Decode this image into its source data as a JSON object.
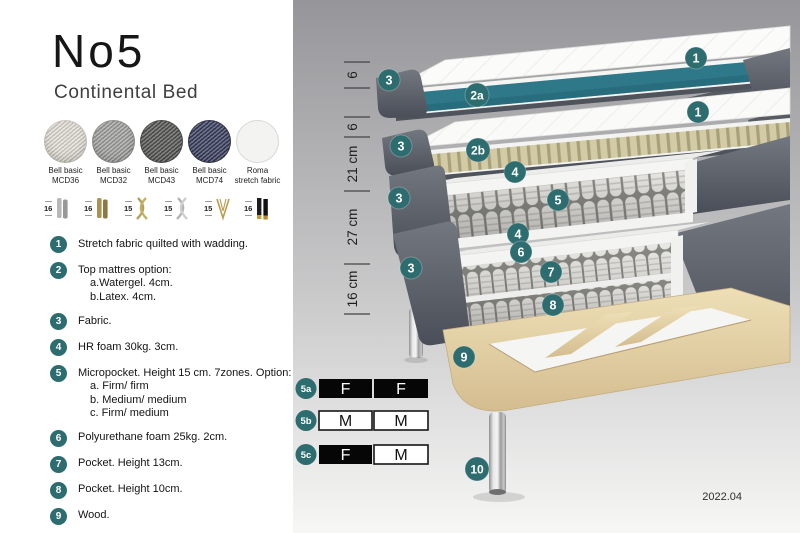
{
  "header": {
    "title": "No5",
    "subtitle": "Continental Bed"
  },
  "fabrics": [
    {
      "name": "Bell basic",
      "code": "MCD36",
      "swatch_style": "background:#e2dfd6"
    },
    {
      "name": "Bell basic",
      "code": "MCD32",
      "swatch_style": "background:#a2a2a0"
    },
    {
      "name": "Bell basic",
      "code": "MCD43",
      "swatch_style": "background:#565654"
    },
    {
      "name": "Bell basic",
      "code": "MCD74",
      "swatch_style": "background:#3b3f5e"
    },
    {
      "name": "Roma",
      "code": "stretch fabric",
      "swatch_style": "background:#f3f3f1"
    }
  ],
  "legs": [
    {
      "height": "16",
      "finish": "chrome cylinder"
    },
    {
      "height": "16",
      "finish": "brass cylinder"
    },
    {
      "height": "15",
      "finish": "gold twisted"
    },
    {
      "height": "15",
      "finish": "silver twisted"
    },
    {
      "height": "15",
      "finish": "gold hairpin"
    },
    {
      "height": "16",
      "finish": "black with gold tip"
    }
  ],
  "features": [
    {
      "num": "1",
      "lines": [
        "Stretch fabric quilted with wadding."
      ]
    },
    {
      "num": "2",
      "lines": [
        "Top mattres option:",
        "a.Watergel. 4cm.",
        "b.Latex. 4cm."
      ]
    },
    {
      "num": "3",
      "lines": [
        "Fabric."
      ]
    },
    {
      "num": "4",
      "lines": [
        "HR foam 30kg. 3cm."
      ]
    },
    {
      "num": "5",
      "lines": [
        "Micropocket. Height 15 cm. 7zones. Option:",
        "a. Firm/ firm",
        "b. Medium/ medium",
        "c. Firm/ medium"
      ]
    },
    {
      "num": "6",
      "lines": [
        "Polyurethane foam 25kg. 2cm."
      ]
    },
    {
      "num": "7",
      "lines": [
        "Pocket. Height 13cm."
      ]
    },
    {
      "num": "8",
      "lines": [
        "Pocket. Height 10cm."
      ]
    },
    {
      "num": "9",
      "lines": [
        "Wood."
      ]
    },
    {
      "num": "10",
      "lines": [
        "Metal leg. Height 16cm."
      ]
    }
  ],
  "diagram": {
    "measurements": [
      "6",
      "6",
      "21 cm",
      "27 cm",
      "16 cm"
    ],
    "callouts": {
      "n1": "1",
      "n2a": "2a",
      "n2b": "2b",
      "n3": "3",
      "n4": "4",
      "n5": "5",
      "n6": "6",
      "n7": "7",
      "n8": "8",
      "n9": "9",
      "n10": "10"
    },
    "firmness_table": {
      "rows": [
        {
          "label": "5a",
          "left": "F",
          "right": "F"
        },
        {
          "label": "5b",
          "left": "M",
          "right": "M"
        },
        {
          "label": "5c",
          "left": "F",
          "right": "M"
        }
      ]
    },
    "version": "2022.04",
    "colors": {
      "callout": "#2d6c6f",
      "topper_core": "#2e7889",
      "fabric_gray": "#62666f",
      "latex": "#d0c9a4",
      "wood": "#e2cfa2"
    }
  }
}
